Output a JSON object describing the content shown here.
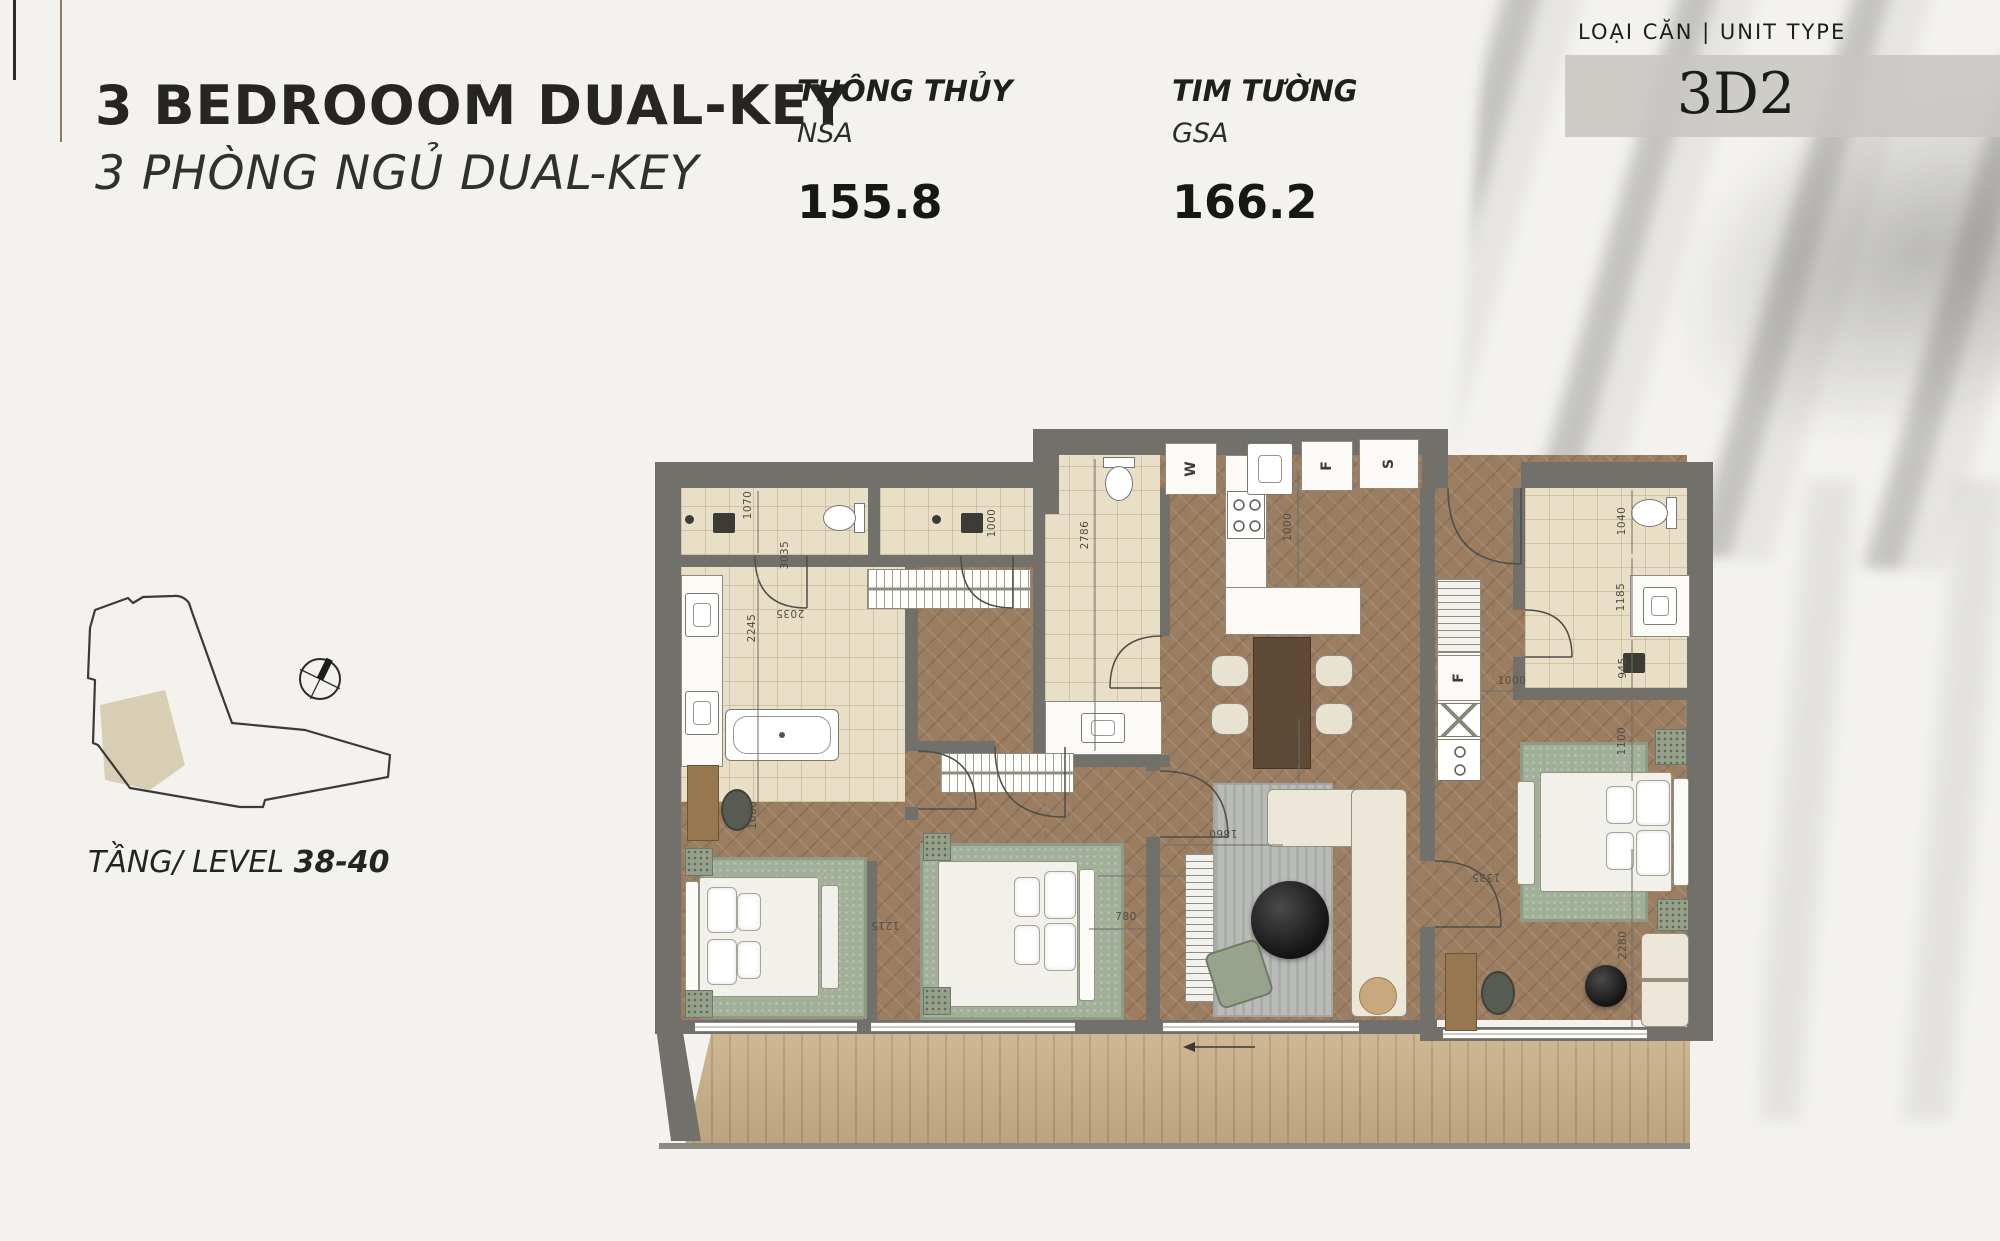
{
  "header": {
    "title": "3 BEDROOOM DUAL-KEY",
    "subtitle": "3 PHÒNG NGỦ DUAL-KEY",
    "metrics": [
      {
        "label": "THÔNG THỦY",
        "code": "NSA",
        "value": "155.8"
      },
      {
        "label": "TIM TƯỜNG",
        "code": "GSA",
        "value": "166.2"
      }
    ],
    "unit_type_label": "LOẠI CĂN | UNIT TYPE",
    "unit_type_value": "3D2"
  },
  "locator": {
    "level_label": "TẦNG/ LEVEL ",
    "level_value": "38-40"
  },
  "plan": {
    "appliance_labels": [
      "W",
      "F",
      "S",
      "F"
    ],
    "dimensions": [
      "1070",
      "2245",
      "2035",
      "1000",
      "2786",
      "1000",
      "1040",
      "1185",
      "945",
      "1000",
      "1100",
      "1680",
      "1215",
      "780",
      "1860",
      "1550",
      "1335",
      "2280",
      "3035"
    ]
  },
  "colors": {
    "wall": "#71706a",
    "wood_floor": "#9b7d61",
    "tile_floor": "#e9dec6",
    "balcony_deck": "#c9af88",
    "rug_green": "#a2af99",
    "rug_gray": "#b8bbb7",
    "unit_box": "#c7c6c2",
    "highlight_unit": "#d7ceb3",
    "accent_line": "#8d7c5a"
  }
}
